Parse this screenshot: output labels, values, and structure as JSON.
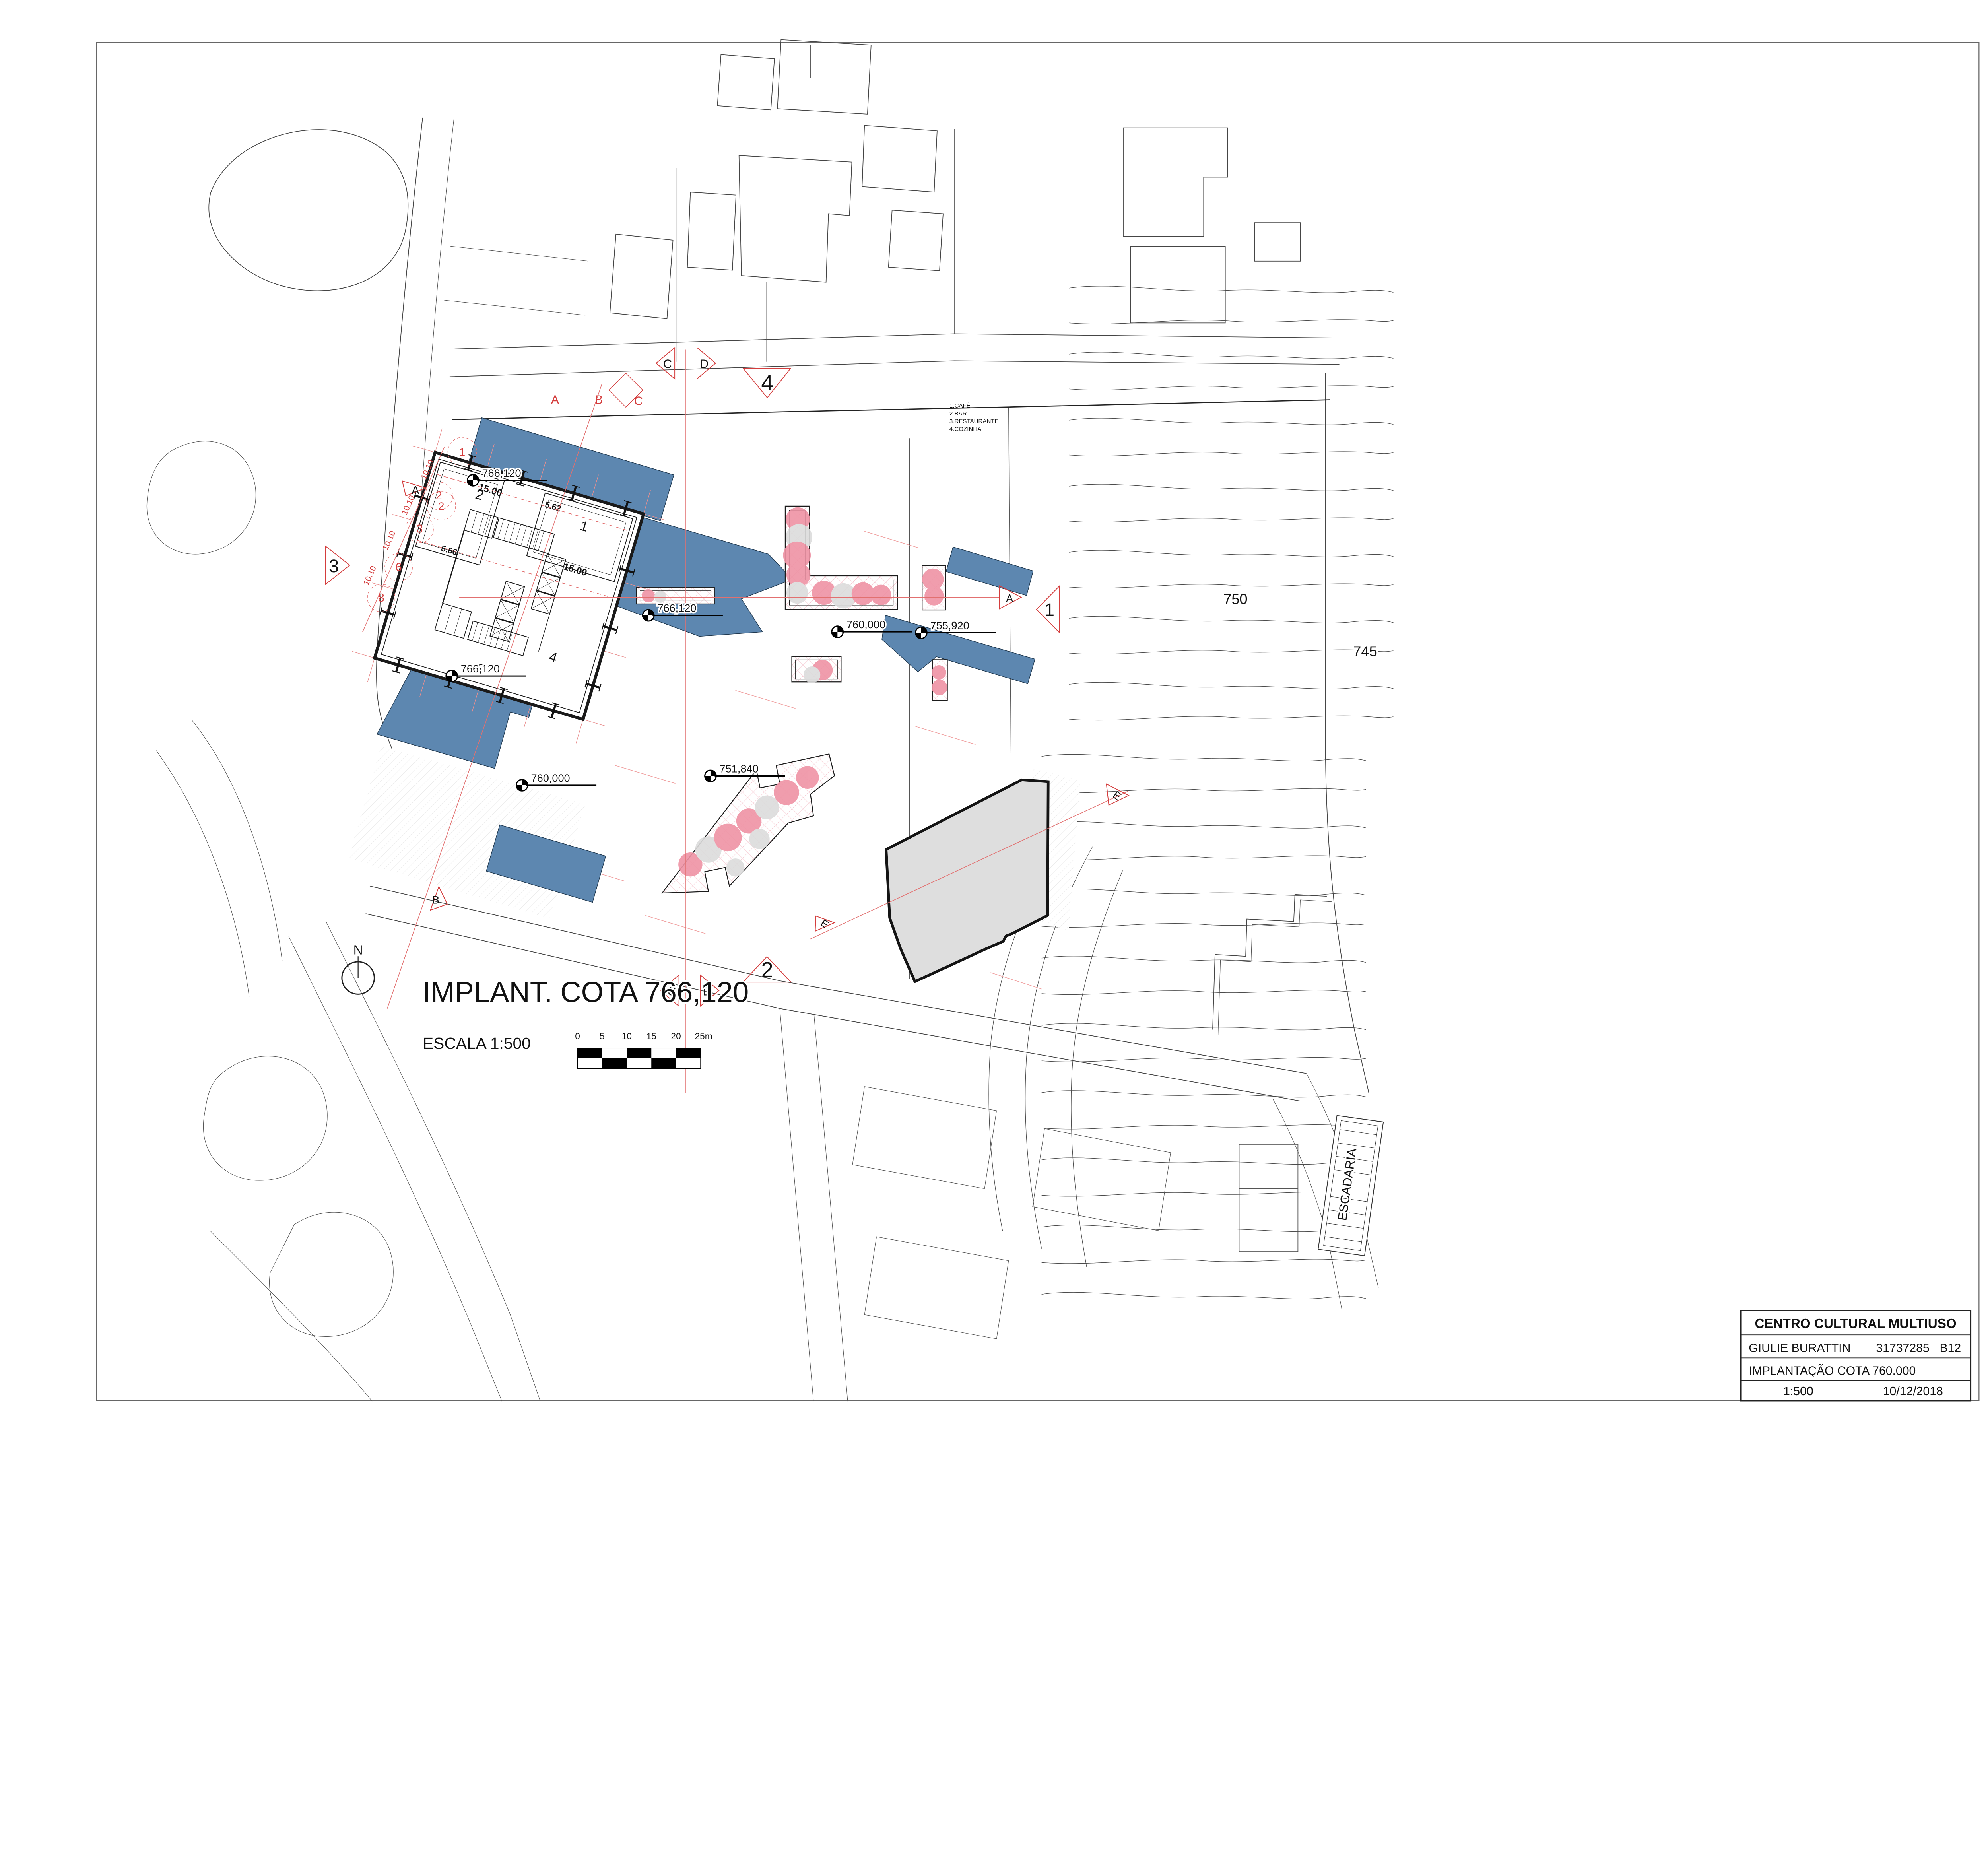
{
  "sheet": {
    "plan_title": "IMPLANT. COTA 766,120",
    "plan_scale": "ESCALA 1:500",
    "north": "N",
    "escadaria": "ESCADARIA"
  },
  "title_block": {
    "project": "CENTRO CULTURAL MULTIUSO",
    "author": "GIULIE BURATTIN",
    "student_id": "31737285",
    "class_code": "B12",
    "sheet_name": "IMPLANTAÇÃO COTA 760.000",
    "scale": "1:500",
    "date": "10/12/2018"
  },
  "legend": {
    "items": [
      "1.CAFÉ",
      "2.BAR",
      "3.RESTAURANTE",
      "4.COZINHA"
    ]
  },
  "scale_bar": {
    "labels": [
      "0",
      "5",
      "10",
      "15",
      "20",
      "25m"
    ]
  },
  "contour_labels": {
    "c750": "750",
    "c745": "745"
  },
  "rooms": {
    "r1": "1",
    "r2": "2",
    "r3": "3",
    "r4": "4"
  },
  "dims": {
    "d1": "15.00",
    "d2": "5.62",
    "d3": "5.66",
    "d4": "15.00"
  },
  "grid": {
    "spacing": "10.10",
    "letters": {
      "a": "A",
      "b": "B",
      "c": "C"
    },
    "numbers": {
      "n1": "1",
      "n2": "2",
      "n3": "3",
      "n6": "6",
      "n8": "8"
    }
  },
  "sections": {
    "s1": "1",
    "s2": "2",
    "s3": "3",
    "s4": "4",
    "a": "A",
    "b": "B",
    "c": "C",
    "d": "D",
    "e": "E"
  },
  "elevations": {
    "e766": "766,120",
    "e760": "760,000",
    "e755": "755,920",
    "e751": "751,840"
  },
  "colors": {
    "canopy_blue": "#5d87b0",
    "annotation_red": "#d43d3d",
    "planting_pink": "#f3b7c3",
    "tree_pink": "#ef93a5",
    "building_gray": "#dedede"
  }
}
